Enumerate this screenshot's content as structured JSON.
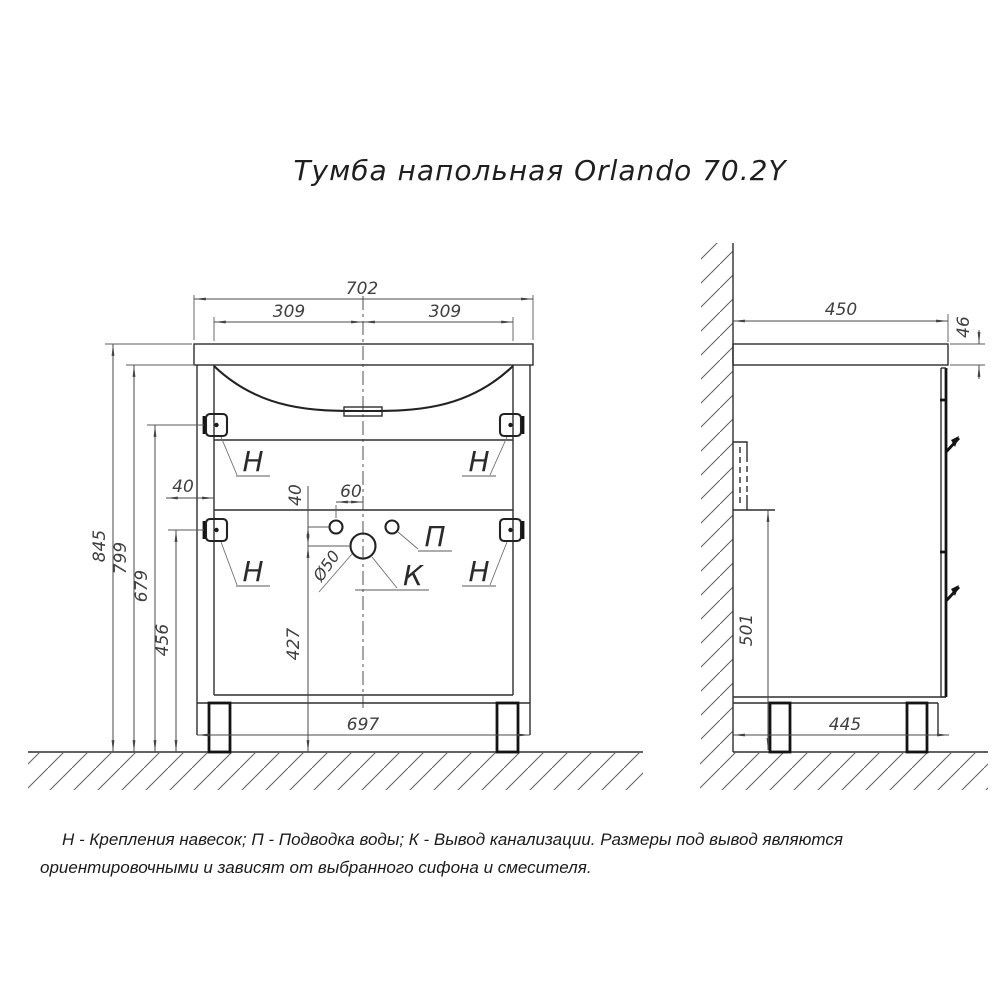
{
  "title": "Тумба напольная Orlando 70.2Y",
  "colors": {
    "background": "#ffffff",
    "outline": "#2e2e2e",
    "dimension": "#4a4a4a",
    "hatch": "#5f5f5f"
  },
  "front_view": {
    "dims": {
      "overall_width": "702",
      "basin_center_left": "309",
      "basin_center_right": "309",
      "height_overall": "845",
      "height_under_countertop": "799",
      "height_top_bracket": "679",
      "height_bottom_bracket": "456",
      "bracket_offset": "40",
      "pipes_vertical_gap": "40",
      "water_offset_center": "60",
      "drain_height": "427",
      "base_width": "697",
      "drain_diameter": "Ø50"
    },
    "labels": {
      "bracket": "Н",
      "water_supply": "П",
      "drain": "К"
    }
  },
  "side_view": {
    "dims": {
      "depth_top": "450",
      "countertop_thickness": "46",
      "rail_bottom_height": "501",
      "base_depth": "445"
    }
  },
  "note": {
    "line1": "Н - Крепления навесок; П - Подводка воды; К - Вывод канализации. Размеры под вывод являются",
    "line2": "ориентировочными и зависят от выбранного сифона и смесителя."
  }
}
